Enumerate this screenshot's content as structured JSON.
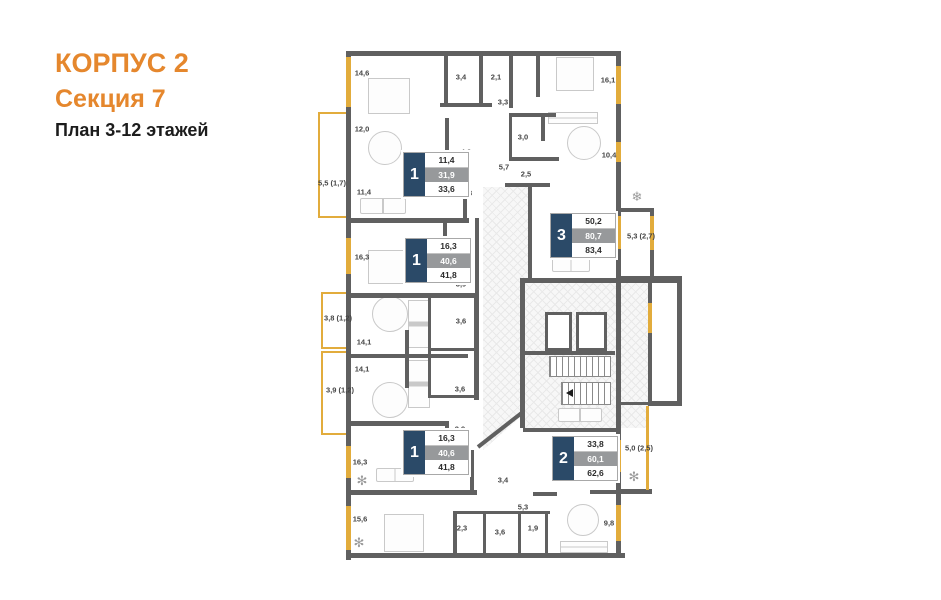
{
  "header": {
    "building": "КОРПУС 2",
    "section": "Секция 7",
    "floors": "План 3-12 этажей"
  },
  "colors": {
    "accent_orange": "#E5872D",
    "wall_gray": "#606060",
    "window_yellow": "#E2AC3C",
    "badge_navy": "#2B4A68",
    "badge_gray": "#97999B"
  },
  "apartments": [
    {
      "rooms": "1",
      "rows": [
        "11,4",
        "31,9",
        "33,6"
      ]
    },
    {
      "rooms": "1",
      "rows": [
        "16,3",
        "40,6",
        "41,8"
      ]
    },
    {
      "rooms": "3",
      "rows": [
        "50,2",
        "80,7",
        "83,4"
      ]
    },
    {
      "rooms": "1",
      "rows": [
        "16,3",
        "40,6",
        "41,8"
      ]
    },
    {
      "rooms": "2",
      "rows": [
        "33,8",
        "60,1",
        "62,6"
      ]
    }
  ],
  "icons": {
    "ac": "❄",
    "plant": "✻"
  },
  "labels": [
    {
      "t": "14,6",
      "x": 362,
      "y": 73
    },
    {
      "t": "3,4",
      "x": 461,
      "y": 77
    },
    {
      "t": "2,1",
      "x": 496,
      "y": 77
    },
    {
      "t": "3,3",
      "x": 503,
      "y": 102
    },
    {
      "t": "16,1",
      "x": 608,
      "y": 80
    },
    {
      "t": "12,0",
      "x": 362,
      "y": 129
    },
    {
      "t": "5,5 (1,7)",
      "x": 332,
      "y": 183
    },
    {
      "t": "11,4",
      "x": 364,
      "y": 192
    },
    {
      "t": "4,2",
      "x": 466,
      "y": 152
    },
    {
      "t": "5,7",
      "x": 504,
      "y": 167
    },
    {
      "t": "3,0",
      "x": 523,
      "y": 137
    },
    {
      "t": "2,5",
      "x": 526,
      "y": 174
    },
    {
      "t": "10,4",
      "x": 609,
      "y": 155
    },
    {
      "t": "4,3",
      "x": 467,
      "y": 193
    },
    {
      "t": "16,3",
      "x": 362,
      "y": 257
    },
    {
      "t": "2,7",
      "x": 463,
      "y": 244
    },
    {
      "t": "19,5",
      "x": 608,
      "y": 235
    },
    {
      "t": "5,3 (2,7)",
      "x": 641,
      "y": 236
    },
    {
      "t": "3,9",
      "x": 461,
      "y": 284
    },
    {
      "t": "3,8 (1,2)",
      "x": 338,
      "y": 318
    },
    {
      "t": "3,6",
      "x": 461,
      "y": 321
    },
    {
      "t": "14,1",
      "x": 364,
      "y": 342
    },
    {
      "t": "14,1",
      "x": 362,
      "y": 369
    },
    {
      "t": "3,6",
      "x": 460,
      "y": 389
    },
    {
      "t": "3,9 (1,2)",
      "x": 340,
      "y": 390
    },
    {
      "t": "3,9",
      "x": 460,
      "y": 429
    },
    {
      "t": "16,3",
      "x": 360,
      "y": 462
    },
    {
      "t": "2,7",
      "x": 463,
      "y": 471
    },
    {
      "t": "3,4",
      "x": 503,
      "y": 480
    },
    {
      "t": "18,2",
      "x": 607,
      "y": 447
    },
    {
      "t": "5,0 (2,5)",
      "x": 639,
      "y": 448
    },
    {
      "t": "15,6",
      "x": 360,
      "y": 519
    },
    {
      "t": "2,3",
      "x": 462,
      "y": 528
    },
    {
      "t": "3,6",
      "x": 500,
      "y": 532
    },
    {
      "t": "1,9",
      "x": 533,
      "y": 528
    },
    {
      "t": "5,3",
      "x": 523,
      "y": 507
    },
    {
      "t": "9,8",
      "x": 609,
      "y": 523
    }
  ]
}
